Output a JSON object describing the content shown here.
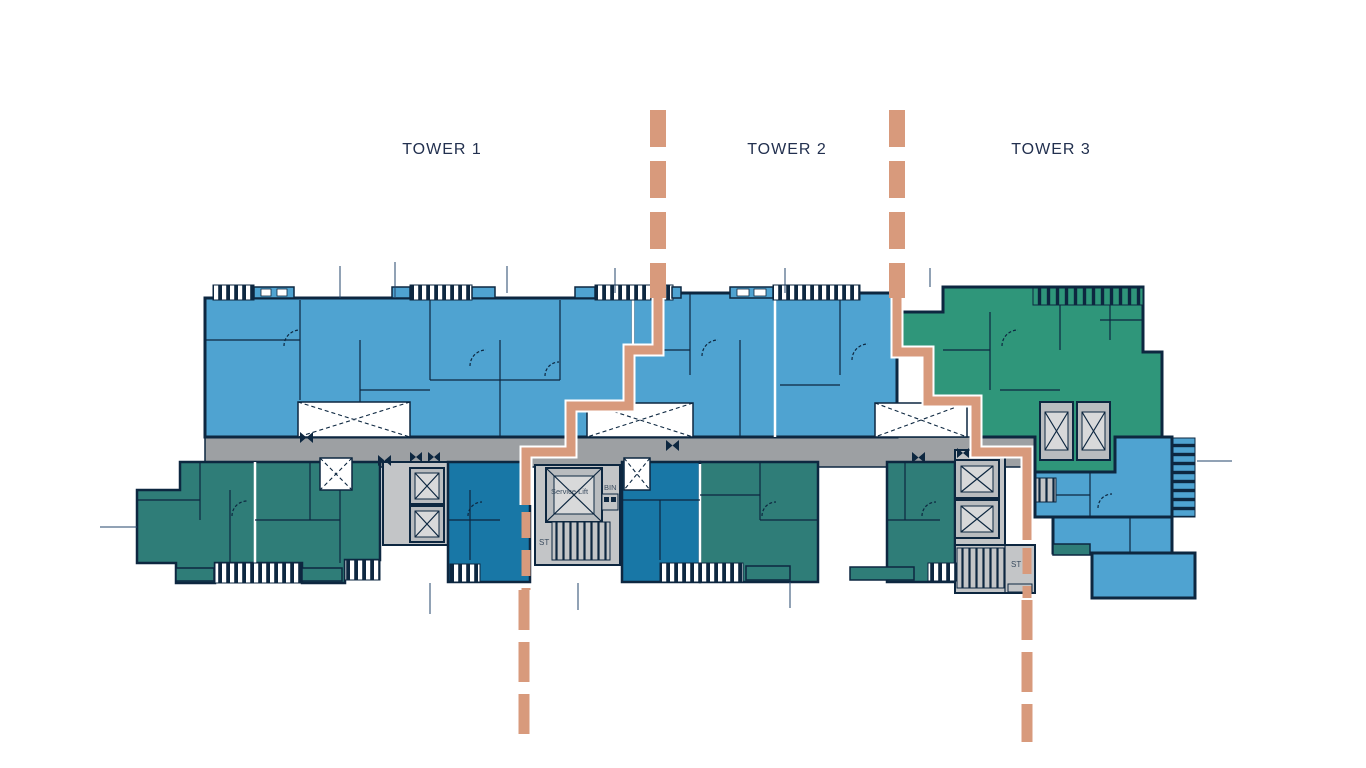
{
  "slide": {
    "background": "#ffffff",
    "description_type": "architectural-floor-plan"
  },
  "towers": {
    "tower1": "TOWER 1",
    "tower2": "TOWER 2",
    "tower3": "TOWER 3"
  },
  "plan_labels": {
    "service_lift": "Service Lift",
    "bin": "BIN",
    "stair": "ST",
    "annotation": "2"
  },
  "colors": {
    "label_navy": "#22304f",
    "tower_divider_salmon": "#d89a7c",
    "unit_light_blue": "#4fa3d1",
    "unit_teal": "#2f7d78",
    "unit_dark_blue": "#1877a6",
    "unit_green": "#2f967a",
    "wall_navy": "#0d2740",
    "corridor_gray": "#9da0a3",
    "core_gray": "#c3c5c7",
    "elevator_gray": "#b9bcbf",
    "void_white": "#ffffff"
  }
}
